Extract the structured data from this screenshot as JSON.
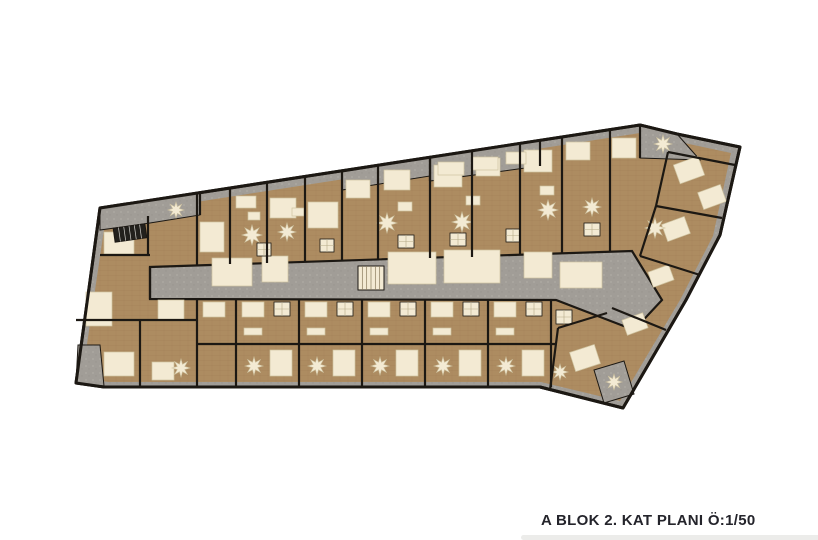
{
  "caption": {
    "text": "A BLOK 2. KAT PLANI Ö:1/50"
  },
  "colors": {
    "background": "#ffffff",
    "wood": "#ad8c61",
    "wood_line": "#97784e",
    "cream": "#f3ead3",
    "cream_edge": "#cfc3a0",
    "gray": "#a19d97",
    "gray_light": "#b8b5af",
    "wall": "#1c1813",
    "caption_text": "#24242b",
    "caption_bar": "#ececea"
  },
  "plan": {
    "outline": [
      [
        100,
        208
      ],
      [
        640,
        125
      ],
      [
        677,
        134
      ],
      [
        740,
        147
      ],
      [
        720,
        235
      ],
      [
        686,
        300
      ],
      [
        623,
        408
      ],
      [
        540,
        387
      ],
      [
        104,
        387
      ],
      [
        76,
        383
      ]
    ],
    "wood": [
      [
        106,
        216
      ],
      [
        640,
        133
      ],
      [
        675,
        141
      ],
      [
        731,
        153
      ],
      [
        713,
        236
      ],
      [
        680,
        300
      ],
      [
        620,
        401
      ],
      [
        541,
        382
      ],
      [
        108,
        382
      ],
      [
        82,
        378
      ]
    ],
    "corridor": [
      [
        150,
        267
      ],
      [
        632,
        251
      ],
      [
        662,
        300
      ],
      [
        634,
        330
      ],
      [
        556,
        300
      ],
      [
        150,
        299
      ]
    ],
    "corridor_panels": [
      [
        212,
        258,
        40,
        28
      ],
      [
        262,
        256,
        26,
        26
      ],
      [
        388,
        252,
        48,
        32
      ],
      [
        444,
        250,
        56,
        33
      ],
      [
        524,
        252,
        28,
        26
      ],
      [
        560,
        262,
        42,
        26
      ]
    ],
    "terraces": [
      [
        [
          100,
          208
        ],
        [
          200,
          193
        ],
        [
          200,
          215
        ],
        [
          150,
          223
        ],
        [
          100,
          230
        ]
      ],
      [
        [
          342,
          172
        ],
        [
          430,
          158
        ],
        [
          430,
          176
        ],
        [
          342,
          190
        ]
      ],
      [
        [
          430,
          158
        ],
        [
          540,
          141
        ],
        [
          540,
          166
        ],
        [
          430,
          181
        ]
      ],
      [
        [
          640,
          126
        ],
        [
          677,
          134
        ],
        [
          700,
          160
        ],
        [
          640,
          158
        ]
      ],
      [
        [
          78,
          345
        ],
        [
          100,
          345
        ],
        [
          104,
          386
        ],
        [
          76,
          383
        ]
      ],
      [
        [
          594,
          370
        ],
        [
          624,
          361
        ],
        [
          634,
          394
        ],
        [
          604,
          403
        ]
      ]
    ],
    "furniture": [
      [
        104,
        232,
        30,
        22,
        0
      ],
      [
        86,
        292,
        26,
        34,
        0
      ],
      [
        158,
        300,
        26,
        20,
        0
      ],
      [
        104,
        352,
        30,
        24,
        0
      ],
      [
        152,
        362,
        22,
        18,
        0
      ],
      [
        200,
        222,
        24,
        30,
        0
      ],
      [
        270,
        198,
        26,
        20,
        0
      ],
      [
        308,
        202,
        30,
        26,
        0
      ],
      [
        346,
        180,
        24,
        18,
        0
      ],
      [
        384,
        170,
        26,
        20,
        0
      ],
      [
        434,
        165,
        28,
        22,
        0
      ],
      [
        476,
        158,
        24,
        18,
        0
      ],
      [
        524,
        150,
        28,
        22,
        0
      ],
      [
        566,
        142,
        24,
        18,
        0
      ],
      [
        612,
        138,
        24,
        20,
        0
      ],
      [
        236,
        196,
        20,
        12,
        0
      ],
      [
        248,
        212,
        12,
        8,
        0
      ],
      [
        292,
        208,
        12,
        8,
        0
      ],
      [
        398,
        202,
        14,
        9,
        0
      ],
      [
        466,
        196,
        14,
        9,
        0
      ],
      [
        540,
        186,
        14,
        9,
        0
      ],
      [
        438,
        162,
        26,
        13,
        0
      ],
      [
        472,
        157,
        26,
        13,
        0
      ],
      [
        506,
        152,
        20,
        12,
        0
      ],
      [
        203,
        302,
        22,
        15,
        0
      ],
      [
        242,
        302,
        22,
        15,
        0
      ],
      [
        305,
        302,
        22,
        15,
        0
      ],
      [
        368,
        302,
        22,
        15,
        0
      ],
      [
        431,
        302,
        22,
        15,
        0
      ],
      [
        494,
        302,
        22,
        15,
        0
      ],
      [
        270,
        350,
        22,
        26,
        0
      ],
      [
        333,
        350,
        22,
        26,
        0
      ],
      [
        396,
        350,
        22,
        26,
        0
      ],
      [
        459,
        350,
        22,
        26,
        0
      ],
      [
        522,
        350,
        22,
        26,
        0
      ],
      [
        244,
        328,
        18,
        7,
        0
      ],
      [
        307,
        328,
        18,
        7,
        0
      ],
      [
        370,
        328,
        18,
        7,
        0
      ],
      [
        433,
        328,
        18,
        7,
        0
      ],
      [
        496,
        328,
        18,
        7,
        0
      ],
      [
        676,
        160,
        26,
        20,
        -20
      ],
      [
        700,
        188,
        24,
        18,
        -20
      ],
      [
        664,
        220,
        24,
        18,
        -20
      ],
      [
        650,
        268,
        22,
        16,
        -20
      ],
      [
        624,
        316,
        22,
        16,
        -20
      ],
      [
        572,
        348,
        26,
        20,
        -18
      ]
    ],
    "baths": [
      [
        257,
        243,
        14,
        13
      ],
      [
        320,
        239,
        14,
        13
      ],
      [
        398,
        235,
        16,
        13
      ],
      [
        450,
        233,
        16,
        13
      ],
      [
        506,
        229,
        14,
        13
      ],
      [
        584,
        223,
        16,
        13
      ],
      [
        274,
        302,
        16,
        14
      ],
      [
        337,
        302,
        16,
        14
      ],
      [
        400,
        302,
        16,
        14
      ],
      [
        463,
        302,
        16,
        14
      ],
      [
        526,
        302,
        16,
        14
      ],
      [
        556,
        310,
        16,
        14
      ]
    ],
    "stars": [
      [
        176,
        210,
        8
      ],
      [
        252,
        235,
        10
      ],
      [
        287,
        232,
        9
      ],
      [
        387,
        223,
        10
      ],
      [
        462,
        222,
        10
      ],
      [
        548,
        210,
        10
      ],
      [
        592,
        207,
        9
      ],
      [
        663,
        144,
        9
      ],
      [
        655,
        228,
        10
      ],
      [
        614,
        382,
        8
      ],
      [
        181,
        368,
        9
      ],
      [
        254,
        366,
        9
      ],
      [
        317,
        366,
        9
      ],
      [
        380,
        366,
        9
      ],
      [
        443,
        366,
        9
      ],
      [
        506,
        366,
        9
      ],
      [
        560,
        372,
        8
      ]
    ],
    "stairs": [
      [
        114,
        226,
        32,
        14,
        -8,
        "dark"
      ],
      [
        358,
        266,
        26,
        24,
        0,
        "light"
      ]
    ],
    "walls": [
      [
        197,
        193,
        197,
        265
      ],
      [
        230,
        188,
        230,
        264
      ],
      [
        267,
        182,
        267,
        263
      ],
      [
        305,
        177,
        305,
        262
      ],
      [
        342,
        171,
        342,
        261
      ],
      [
        378,
        165,
        378,
        260
      ],
      [
        430,
        157,
        430,
        258
      ],
      [
        472,
        151,
        472,
        257
      ],
      [
        520,
        144,
        520,
        255
      ],
      [
        562,
        137,
        562,
        254
      ],
      [
        610,
        130,
        610,
        252
      ],
      [
        148,
        216,
        148,
        255
      ],
      [
        100,
        255,
        150,
        255
      ],
      [
        76,
        320,
        197,
        320
      ],
      [
        140,
        320,
        140,
        386
      ],
      [
        150,
        267,
        150,
        299
      ],
      [
        197,
        299,
        197,
        386
      ],
      [
        236,
        299,
        236,
        386
      ],
      [
        299,
        299,
        299,
        386
      ],
      [
        362,
        299,
        362,
        386
      ],
      [
        425,
        300,
        425,
        386
      ],
      [
        488,
        300,
        488,
        386
      ],
      [
        551,
        300,
        551,
        387
      ],
      [
        197,
        344,
        556,
        344
      ],
      [
        550,
        390,
        558,
        328
      ],
      [
        558,
        328,
        607,
        313
      ],
      [
        735,
        165,
        668,
        152
      ],
      [
        722,
        218,
        656,
        206
      ],
      [
        700,
        275,
        640,
        256
      ],
      [
        666,
        330,
        612,
        308
      ],
      [
        668,
        152,
        656,
        206
      ],
      [
        656,
        206,
        640,
        256
      ],
      [
        200,
        193,
        200,
        215
      ],
      [
        430,
        158,
        430,
        181
      ],
      [
        540,
        141,
        540,
        166
      ],
      [
        640,
        126,
        640,
        158
      ]
    ]
  }
}
